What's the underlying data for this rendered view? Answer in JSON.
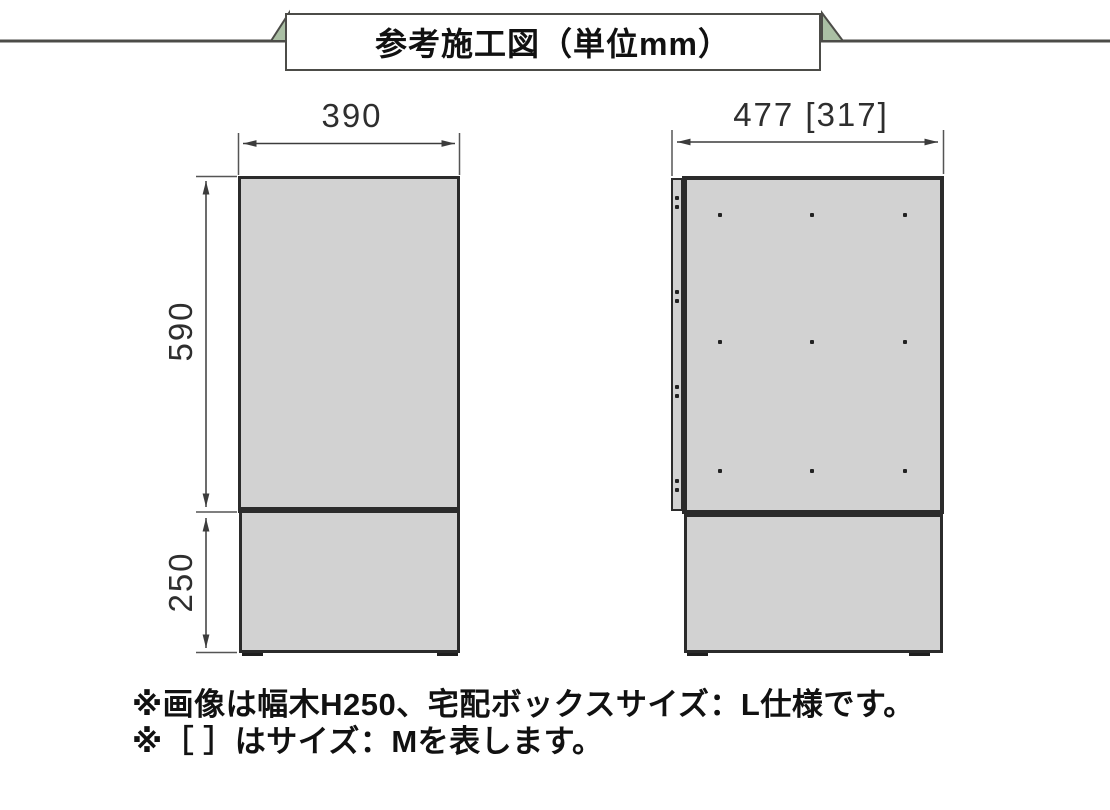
{
  "title": "参考施工図（単位mm）",
  "views": {
    "front": {
      "width_dim": "390",
      "body_height_dim": "590",
      "base_height_dim": "250"
    },
    "side": {
      "depth_dim": "477 [317]"
    }
  },
  "notes": {
    "line1": "※画像は幅木H250、宅配ボックスサイズ：L仕様です。",
    "line2": "※［ ］はサイズ：Mを表します。"
  },
  "colors": {
    "panel_fill": "#d2d2d2",
    "outline": "#2b2b2b",
    "banner_accent_green": "#aabfa4",
    "rule_line": "#4c4c48",
    "dimension_line": "#3c3c3c"
  }
}
